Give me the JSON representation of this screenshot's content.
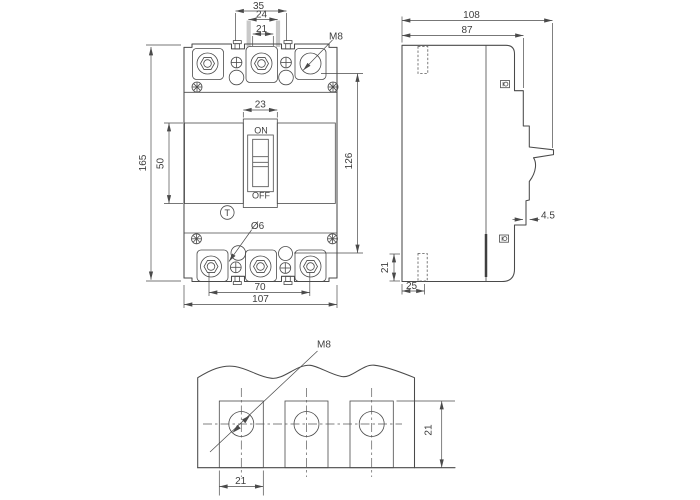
{
  "drawing_type": "circuit-breaker dimensional drawing",
  "colors": {
    "line": "#4a4a4a",
    "background": "#ffffff",
    "barrier_band": "#c9c9c9"
  },
  "front_view": {
    "dims": {
      "tab_pitch": "35",
      "terminal_pitch": "24",
      "terminal_width": "21",
      "overall_height": "165",
      "cover_height": "50",
      "handle_window_width": "23",
      "hole_to_terminal_span": "126",
      "mount_hole_span": "70",
      "overall_width": "107"
    },
    "labels": {
      "thread_callout": "M8",
      "switch_on": "ON",
      "switch_off": "OFF",
      "trip_button": "T",
      "mount_hole_callout": "Ø6"
    }
  },
  "side_view": {
    "dims": {
      "overall_depth": "108",
      "body_depth": "87",
      "rail_step": "4.5",
      "hole_height": "21",
      "hole_setback": "25"
    }
  },
  "detail_view": {
    "labels": {
      "thread_callout": "M8"
    },
    "dims": {
      "pad_width": "21",
      "pad_height": "21"
    }
  }
}
